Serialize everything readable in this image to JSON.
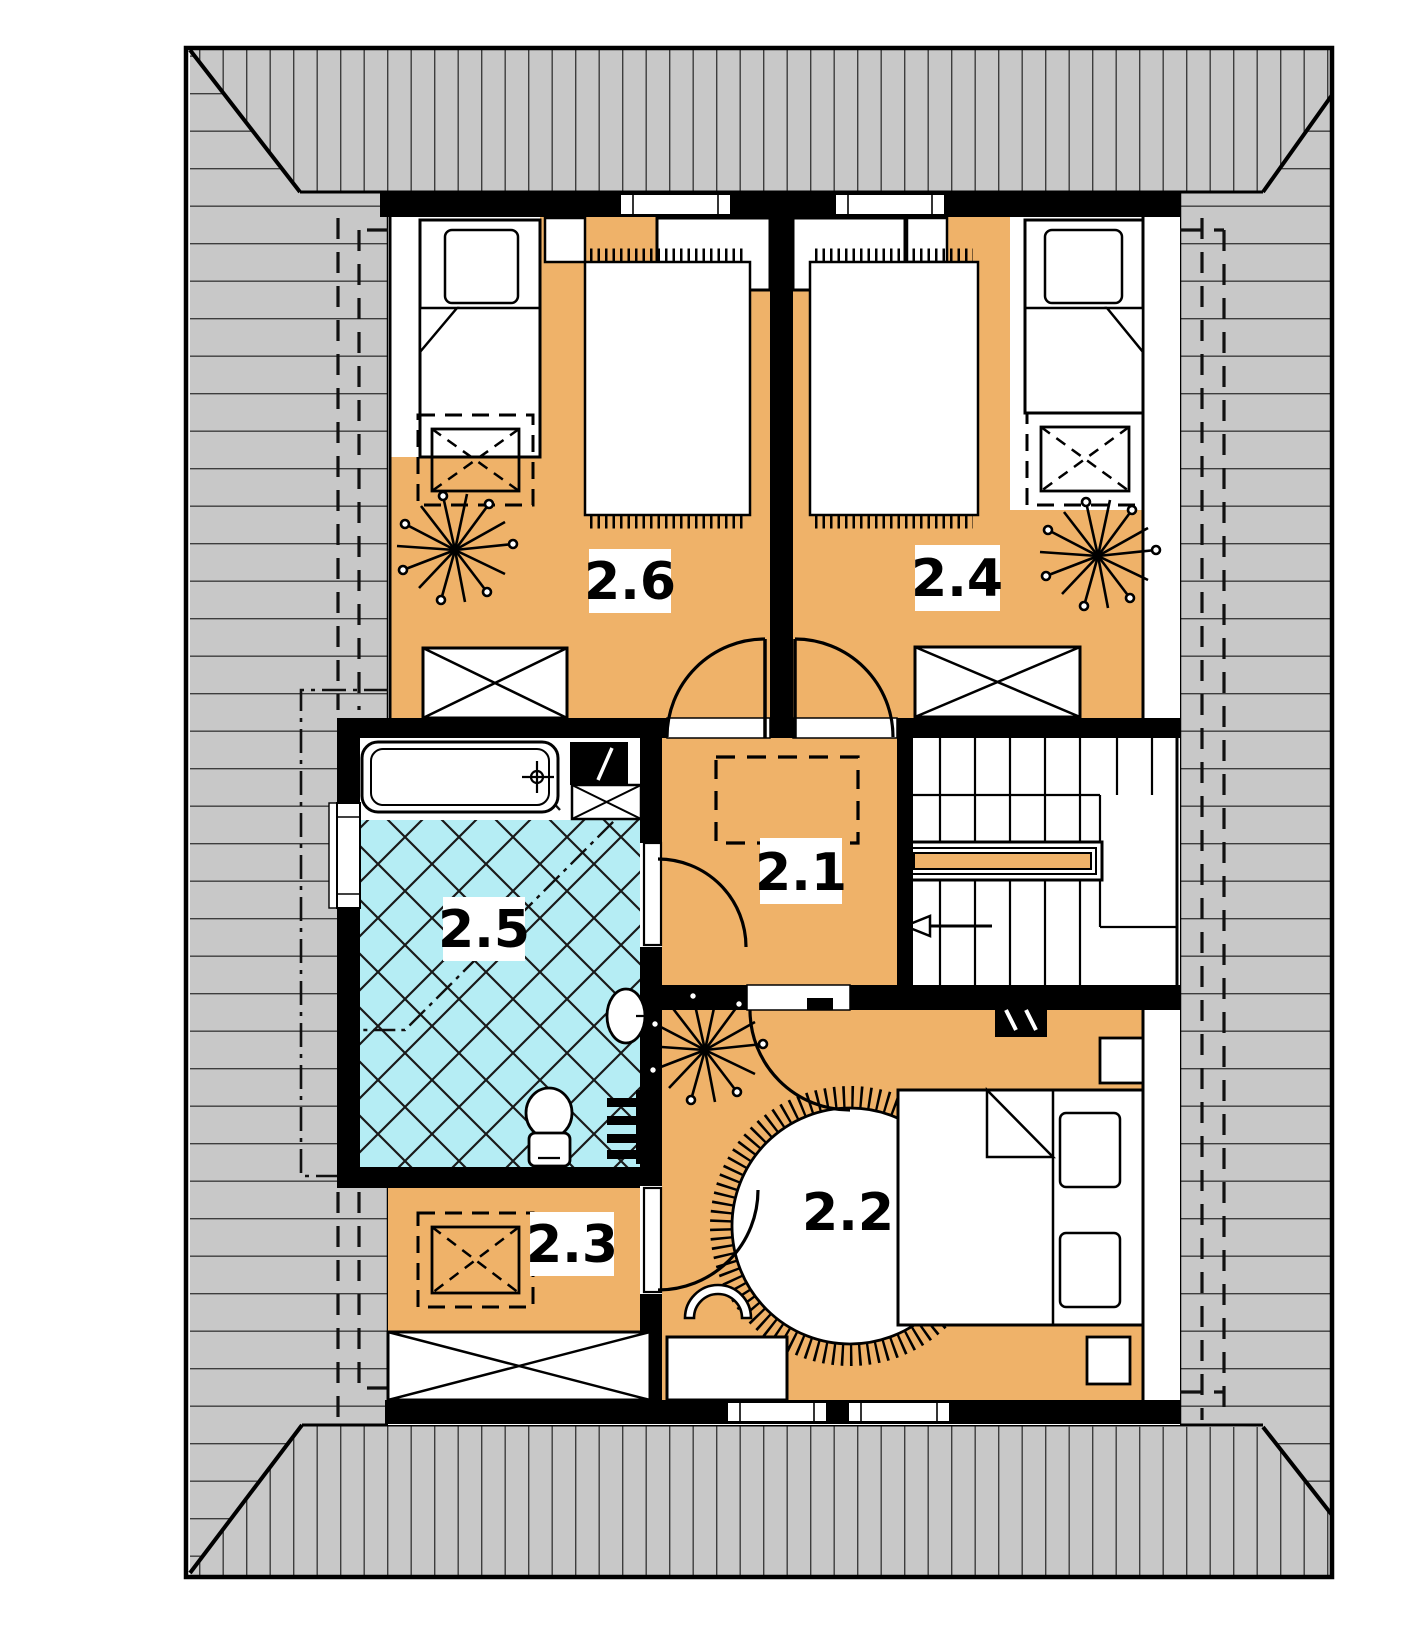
{
  "floor_plan": {
    "rooms": [
      {
        "label": "2.1"
      },
      {
        "label": "2.2"
      },
      {
        "label": "2.3"
      },
      {
        "label": "2.4"
      },
      {
        "label": "2.5"
      },
      {
        "label": "2.6"
      }
    ],
    "colors": {
      "floor_orange": "#efb269",
      "tile_cyan": "#b5edf4",
      "roof_gray": "#c8c8c8",
      "wall_black": "#000000",
      "background": "#ffffff"
    },
    "icons": [
      "roof-hatch-icon",
      "bed-icon",
      "pillow-icon",
      "desk-icon",
      "chair-icon",
      "wardrobe-icon",
      "dresser-icon",
      "carpet-icon",
      "round-rug-icon",
      "plant-icon",
      "bathtub-icon",
      "washbasin-icon",
      "toilet-icon",
      "washing-machine-icon",
      "radiator-icon",
      "stairs-icon",
      "handrail-icon",
      "direction-arrow-icon",
      "window-icon",
      "door-icon",
      "light-switch-icon"
    ]
  }
}
